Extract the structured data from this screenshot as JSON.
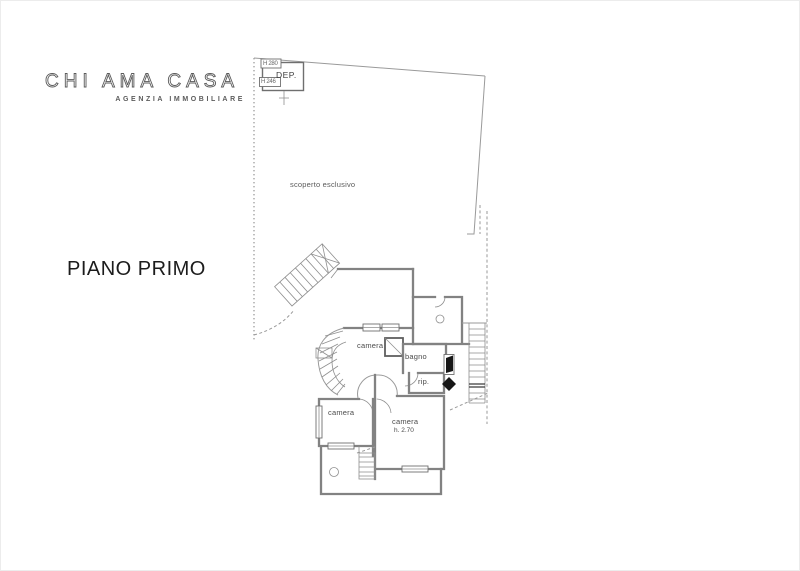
{
  "logo": {
    "title": "CHI AMA CASA",
    "subtitle": "AGENZIA IMMOBILIARE"
  },
  "plan": {
    "floor_title": "PIANO PRIMO",
    "outdoor": {
      "label": "scoperto esclusivo"
    },
    "storage": {
      "label": "DEP.",
      "height_top": "H 280",
      "height_bottom": "H 246"
    },
    "rooms": {
      "bedroom_upper": {
        "label": "camera"
      },
      "bathroom": {
        "label": "bagno"
      },
      "closet": {
        "label": "rip."
      },
      "bedroom_left": {
        "label": "camera"
      },
      "bedroom_right": {
        "label": "camera",
        "height": "h. 2.70"
      }
    }
  },
  "colors": {
    "wall": "#828282",
    "wall_dark": "#3c3c3c",
    "line_light": "#9a9a9a",
    "text": "#4a4a4a",
    "title": "#1c1c1c"
  }
}
